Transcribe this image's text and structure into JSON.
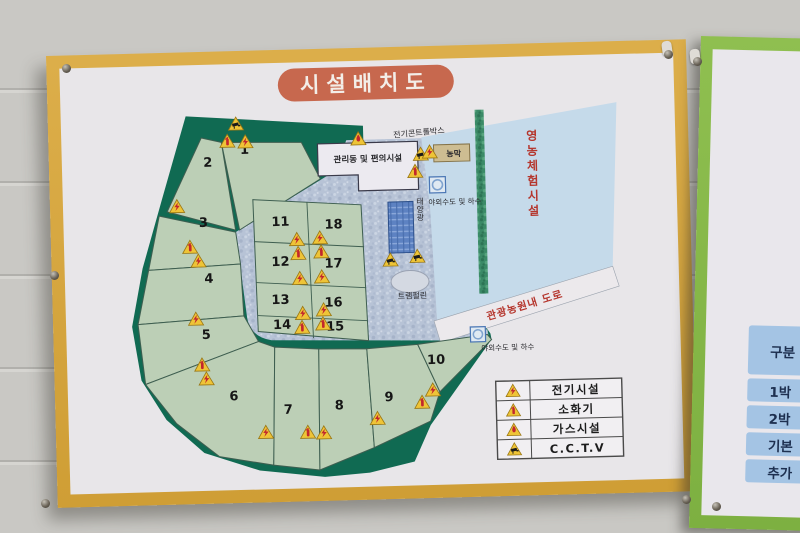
{
  "signboard": {
    "title": "시설배치도",
    "colors": {
      "frame": "#d8a83f",
      "face": "#e8e6e9",
      "title_bg": "#c7684e",
      "forest": "#106a52",
      "plots": "#bccfb6",
      "road": "#b7c3d6",
      "blue_area": "#c5daea",
      "red_text": "#b5352c"
    },
    "legend": {
      "items": [
        {
          "type": "electric",
          "label": "전기시설"
        },
        {
          "type": "fire",
          "label": "소화기"
        },
        {
          "type": "gas",
          "label": "가스시설"
        },
        {
          "type": "cctv",
          "label": "C.C.T.V"
        }
      ]
    },
    "plots": [
      {
        "n": "1",
        "x": 183,
        "y": 90
      },
      {
        "n": "2",
        "x": 146,
        "y": 102
      },
      {
        "n": "3",
        "x": 140,
        "y": 162
      },
      {
        "n": "4",
        "x": 144,
        "y": 218
      },
      {
        "n": "5",
        "x": 140,
        "y": 274
      },
      {
        "n": "6",
        "x": 166,
        "y": 336
      },
      {
        "n": "7",
        "x": 220,
        "y": 351
      },
      {
        "n": "8",
        "x": 271,
        "y": 348
      },
      {
        "n": "9",
        "x": 321,
        "y": 341
      },
      {
        "n": "10",
        "x": 369,
        "y": 305
      },
      {
        "n": "11",
        "x": 217,
        "y": 163
      },
      {
        "n": "12",
        "x": 216,
        "y": 203
      },
      {
        "n": "13",
        "x": 215,
        "y": 241
      },
      {
        "n": "14",
        "x": 216,
        "y": 266
      },
      {
        "n": "15",
        "x": 269,
        "y": 269
      },
      {
        "n": "16",
        "x": 268,
        "y": 245
      },
      {
        "n": "17",
        "x": 269,
        "y": 206
      },
      {
        "n": "18",
        "x": 270,
        "y": 167
      }
    ],
    "labels": [
      {
        "id": "electric-control-box",
        "text": "전기콘트롤박스",
        "x": 358,
        "y": 76,
        "size": 8,
        "rotate": -4
      },
      {
        "id": "management-building",
        "text": "관리동 및 편의시설",
        "x": 306,
        "y": 101,
        "size": 8.5,
        "bold": true
      },
      {
        "id": "farm-hut",
        "text": "농막",
        "x": 392,
        "y": 98,
        "size": 8,
        "bold": true
      },
      {
        "id": "outdoor-water-top",
        "text": "야외수도 및 하수",
        "x": 392,
        "y": 146,
        "size": 7.5
      },
      {
        "id": "solar-panel",
        "text": "태양광",
        "x": 357,
        "y": 150,
        "size": 8,
        "vertical": true
      },
      {
        "id": "trampoline",
        "text": "트램펄린",
        "x": 347,
        "y": 239,
        "size": 8
      },
      {
        "id": "farming-experience",
        "text": "영농체험시설",
        "x": 470,
        "y": 118,
        "size": 12,
        "vertical": true,
        "bold": true,
        "color": "#b5352c",
        "ls": 3
      },
      {
        "id": "tour-road",
        "text": "관광농원내 도로",
        "x": 460,
        "y": 252,
        "size": 10.5,
        "rotate": -15.5,
        "bold": true,
        "color": "#b5352c",
        "ls": 1
      },
      {
        "id": "outdoor-water-bottom",
        "text": "야외수도 및 하수",
        "x": 441,
        "y": 293,
        "size": 7.5
      }
    ],
    "icons": [
      {
        "t": "cctv",
        "x": 175,
        "y": 59
      },
      {
        "t": "fire",
        "x": 166,
        "y": 76
      },
      {
        "t": "electric",
        "x": 184,
        "y": 77
      },
      {
        "t": "electric",
        "x": 114,
        "y": 140
      },
      {
        "t": "fire",
        "x": 126,
        "y": 181
      },
      {
        "t": "electric",
        "x": 134,
        "y": 195
      },
      {
        "t": "electric",
        "x": 130,
        "y": 253
      },
      {
        "t": "fire",
        "x": 135,
        "y": 299
      },
      {
        "t": "electric",
        "x": 139,
        "y": 313
      },
      {
        "t": "electric",
        "x": 197,
        "y": 368
      },
      {
        "t": "fire",
        "x": 239,
        "y": 369
      },
      {
        "t": "electric",
        "x": 255,
        "y": 370
      },
      {
        "t": "electric",
        "x": 309,
        "y": 357
      },
      {
        "t": "fire",
        "x": 354,
        "y": 342
      },
      {
        "t": "electric",
        "x": 365,
        "y": 330
      },
      {
        "t": "electric",
        "x": 233,
        "y": 176
      },
      {
        "t": "electric",
        "x": 256,
        "y": 175
      },
      {
        "t": "fire",
        "x": 234,
        "y": 190
      },
      {
        "t": "fire",
        "x": 257,
        "y": 189
      },
      {
        "t": "electric",
        "x": 235,
        "y": 215
      },
      {
        "t": "electric",
        "x": 257,
        "y": 214
      },
      {
        "t": "electric",
        "x": 237,
        "y": 250
      },
      {
        "t": "electric",
        "x": 258,
        "y": 247
      },
      {
        "t": "fire",
        "x": 236,
        "y": 264
      },
      {
        "t": "fire",
        "x": 257,
        "y": 261
      },
      {
        "t": "cctv",
        "x": 326,
        "y": 199
      },
      {
        "t": "cctv",
        "x": 353,
        "y": 196
      },
      {
        "t": "gas",
        "x": 297,
        "y": 77
      },
      {
        "t": "cctv",
        "x": 359,
        "y": 94
      },
      {
        "t": "fire",
        "x": 353,
        "y": 111
      },
      {
        "t": "electric",
        "x": 368,
        "y": 92
      }
    ]
  },
  "side_sign": {
    "list_items": [
      {
        "text": "1)",
        "top": 77
      },
      {
        "text": "2)",
        "top": 101
      },
      {
        "text": "3)",
        "top": 125
      },
      {
        "text": "4)",
        "top": 165
      }
    ],
    "table_rows": [
      {
        "text": "구분",
        "h": 49
      },
      {
        "text": "1박",
        "h": 23
      },
      {
        "text": "2박",
        "h": 23
      },
      {
        "text": "기본",
        "h": 23
      },
      {
        "text": "추가",
        "h": 23
      }
    ]
  }
}
